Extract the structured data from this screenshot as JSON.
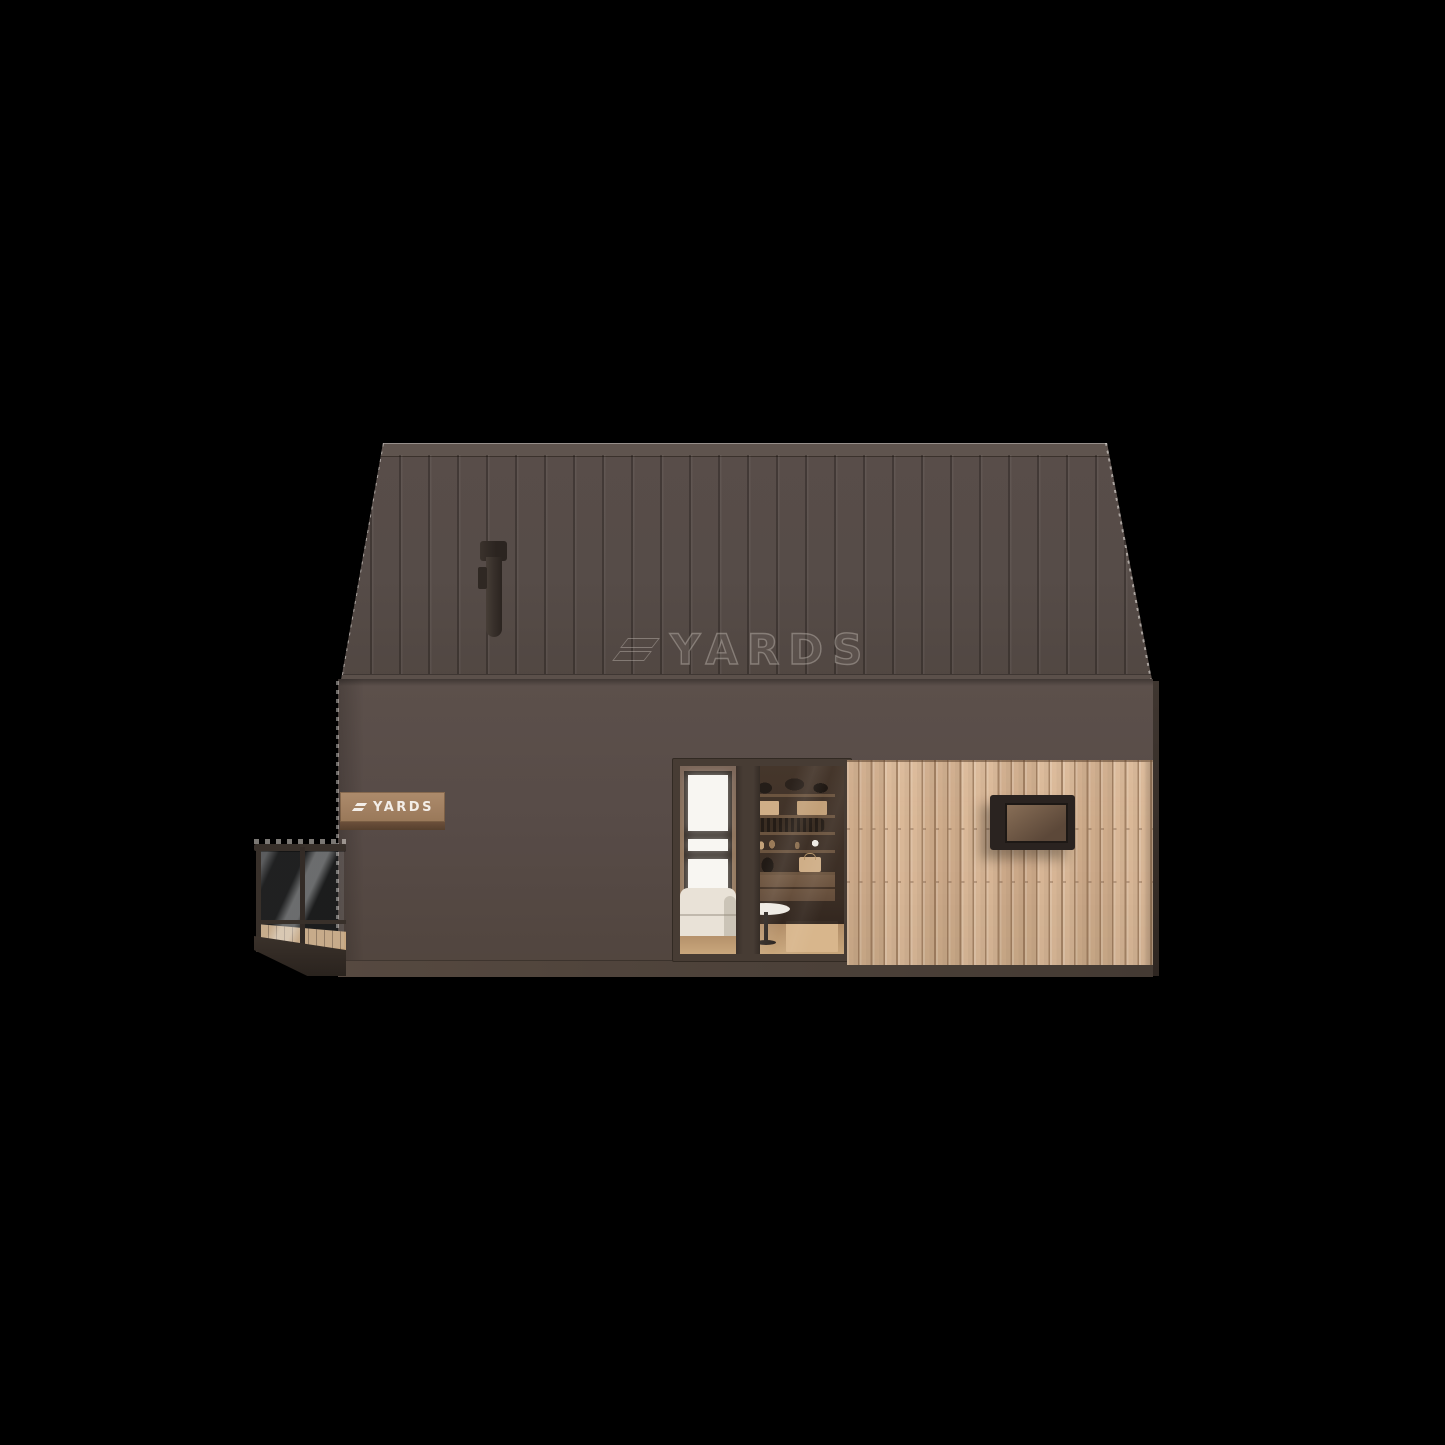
{
  "title": "YARDS barn-style modular cabin — side elevation 3D render",
  "watermark": {
    "text": "YARDS"
  },
  "sign": {
    "text": "YARDS"
  },
  "colors": {
    "bg": "#000000",
    "roof_base": "#564c48",
    "roof_cap": "#5f544e",
    "roof_eave": "#5b504a",
    "wall": "#574b47",
    "wall_side": "#3f3630",
    "plinth": "#4c4139",
    "cladding": "#d8b491",
    "door_frame": "#473c34",
    "interior_wall": "#93785f",
    "interior_dark": "#3a2d24",
    "shelf_wood": "#6b543f",
    "box_tan": "#cfae87",
    "floor_wood": "#c9a77c",
    "sofa": "#e9e2d7",
    "table_white": "#efebe4",
    "window_white": "#f8f6f2",
    "clad_window_frame": "#2a2320",
    "clad_window_glass_hi": "#8a7058",
    "clad_window_glass_lo": "#5c4839",
    "balcony_metal": "#38302a",
    "deck_wood": "#c7a67f",
    "fascia": "#3c332c",
    "sign_wood_hi": "#ad8b6c",
    "sign_wood_lo": "#997859",
    "sign_edge": "#6b4f3a",
    "sign_text": "#f3eee8",
    "chimney": "#362e29",
    "watermark_stroke": "rgba(214,206,198,0.38)"
  }
}
